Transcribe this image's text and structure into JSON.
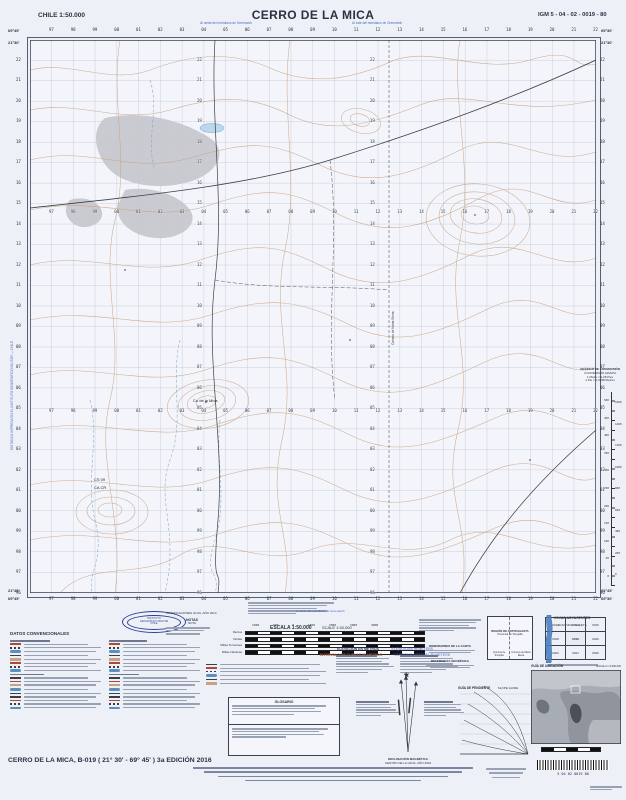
{
  "header": {
    "country_scale": "CHILE 1:50.000",
    "title": "CERRO DE LA MICA",
    "sheet_code": "IGM 5 - 04 - 02 - 0019 - 80",
    "meridian_note_left": "Al oeste del meridiano de Greenwich",
    "meridian_note_right": "Al este del meridiano de Greenwich"
  },
  "map": {
    "corner_top_left_lon": "69°45'",
    "corner_top_left_lat": "21°30'",
    "corner_top_right_lon": "69°30'",
    "corner_top_right_lat": "21°30'",
    "corner_bottom_left_lon": "69°45'",
    "corner_bottom_left_lat": "21°45'",
    "corner_bottom_right_lon": "69°30'",
    "corner_bottom_right_lat": "21°45'",
    "column_labels": "97 98 99 00 01 02 03 04 05 06 07 08 09 10 11 12 13 14 15 16 17 18 19 20 21 22",
    "row_labels": "22 21 20 19 18 17 16 15 14 13 12 11 10 09 08 07 06 05 04 03 02 01 00 99 98 97 96",
    "labels": {
      "peak": "Co de la Mica",
      "cs": "CS 09",
      "ca": "CA CR",
      "track": "Camino de María Elena"
    },
    "margin_note_left": "EDITADA E IMPRESA EN EL INSTITUTO GEOGRÁFICO MILITAR — CHILE"
  },
  "scale_block": {
    "title_es": "ESCALA 1:50.000",
    "title_en": "SCALE 1:50,000",
    "tick_numbers": "1000 500 0 1000 2000 3000 4000",
    "bar_units": [
      "Metros",
      "Yardas",
      "Millas Terrestres",
      "Millas Náuticas"
    ],
    "elevation_es": "ELEVACIÓN EN METROS",
    "elevation_en": "ELEVATIONS IN METERS",
    "interval_es": "INTERVALO DE CURVAS 50 METROS",
    "interval_en": "CONTOUR INTERVAL 50 METERS"
  },
  "notes_block": {
    "modifications": "MODIFICACIONES HOJA, AÑO 2014",
    "title": "NOTAS",
    "subtitle": "NOTA"
  },
  "datos_block": {
    "title": "DATOS CONVENCIONALES"
  },
  "glosario_block": {
    "title": "GLOSARIO"
  },
  "projection_block": {
    "dim_title": "DIMENSIONES DE LA CARTA",
    "geo_title": "REFERENCIA GEODÉSICA"
  },
  "limites_block": {
    "title": "LÍMITES",
    "subtitle": "BOUNDARIES",
    "region": "REGIÓN DE ANTOFAGASTA",
    "provincia": "Provincia de Tocopilla",
    "comuna_left": "Comuna de Tocopilla",
    "comuna_right": "Comuna de María Elena"
  },
  "hojas_block": {
    "title": "HOJAS ADYACENTES",
    "subtitle": "ADJOINING SHEETS",
    "cells": [
      "0013",
      "0014",
      "0015",
      "0018",
      "0019",
      "0020",
      "0023",
      "0024",
      "0025"
    ]
  },
  "ubicacion_block": {
    "title": "GUÍA DE UBICACIÓN",
    "scale": "ESCALA 1:3.500.000"
  },
  "pendiente_block": {
    "title": "GUÍA DE PENDIENTE",
    "subtitle": "SLOPE GUIDE"
  },
  "conversion_block": {
    "line1": "GRÁFICO DE CONVERSIÓN",
    "line2": "CONVERSION GRAPH",
    "line3": "1 Metro = 3,28 Pies",
    "line4": "1 Pie = 0,3048 Metros",
    "meters": "500 450 400 350 300 250 200 150 100 50 0",
    "feet": "1600 1400 1200 1000 800 600 400 200 0"
  },
  "declination_block": {
    "caption1": "DECLINACIÓN MAGNÉTICA",
    "caption2": "CENTRO DE LA HOJA, AÑO 2016"
  },
  "logo": {
    "line1": "INSTITUTO",
    "line2": "GEOGRÁFICO MILITAR",
    "line3": "CHILE"
  },
  "footer": {
    "left": "CERRO DE LA MICA, B-019 ( 21° 30' - 69° 45' ) 3a EDICIÓN 2016",
    "igm_abbr": "IGM",
    "igm_line": "CERRO DE LA MICA  -  1:50.000",
    "barcode_digits": "5    04    02    0019    80"
  }
}
